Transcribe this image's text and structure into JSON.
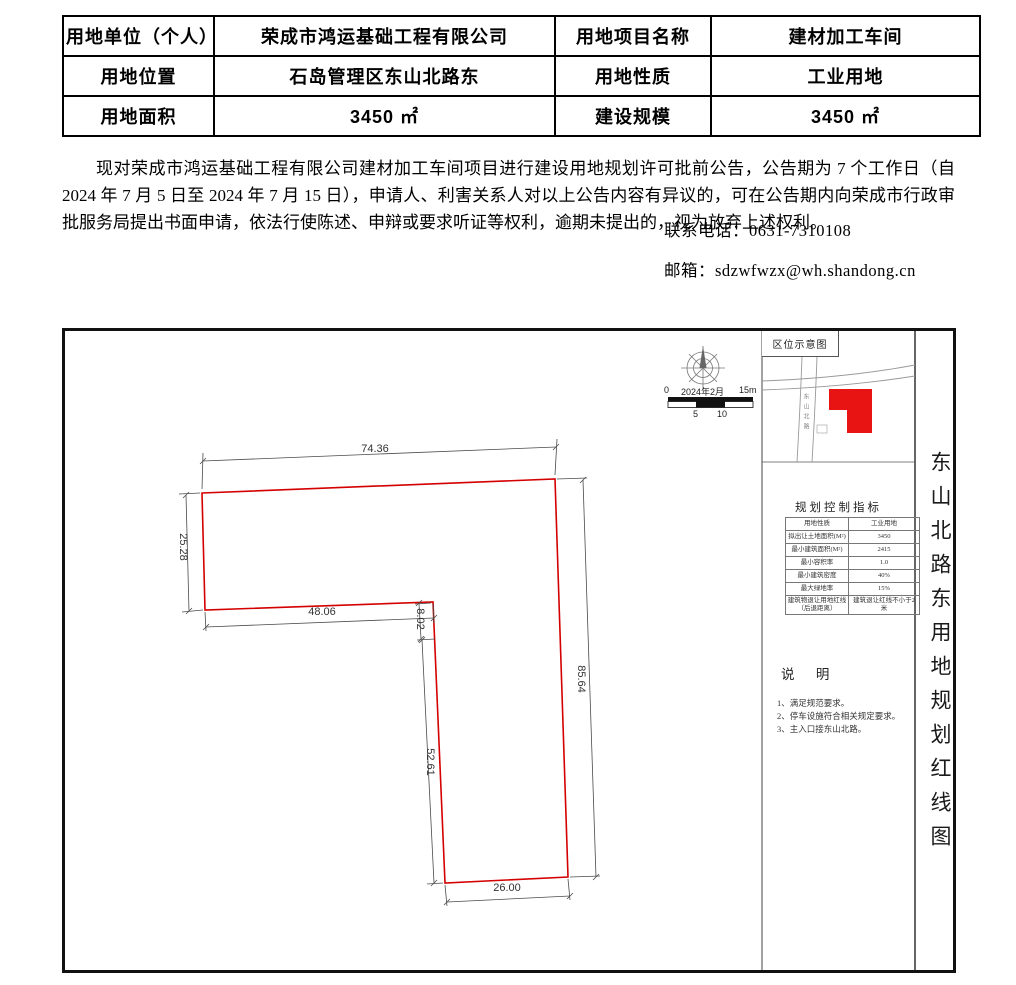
{
  "info_table": {
    "rows": [
      [
        "用地单位（个人）",
        "荣成市鸿运基础工程有限公司",
        "用地项目名称",
        "建材加工车间"
      ],
      [
        "用地位置",
        "石岛管理区东山北路东",
        "用地性质",
        "工业用地"
      ],
      [
        "用地面积",
        "3450 ㎡",
        "建设规模",
        "3450 ㎡"
      ]
    ]
  },
  "announcement": {
    "text": "现对荣成市鸿运基础工程有限公司建材加工车间项目进行建设用地规划许可批前公告，公告期为 7 个工作日（自 2024 年 7 月 5 日至 2024 年 7 月 15 日），申请人、利害关系人对以上公告内容有异议的，可在公告期内向荣成市行政审批服务局提出书面申请，依法行使陈述、申辩或要求听证等权利，逾期未提出的，视为放弃上述权利。"
  },
  "contact": {
    "phone": "联系电话：0631-7310108",
    "email": "邮箱：sdzwfwzx@wh.shandong.cn"
  },
  "figure": {
    "side_title": "东山北路东用地规划红线图",
    "scale_bar": {
      "start": "0",
      "date": "2024年2月",
      "end": "15m",
      "tick5": "5",
      "tick10": "10"
    },
    "dimensions": {
      "top": "74.36",
      "left": "25.28",
      "inner": "48.06",
      "jog": "8.02",
      "leg": "52.61",
      "right": "85.64",
      "bottom": "26.00"
    },
    "inset": {
      "title": "区位示意图",
      "road_name": "东山北路"
    },
    "indicators": {
      "title": "规划控制指标",
      "rows": [
        [
          "用地性质",
          "工业用地"
        ],
        [
          "拟出让土地面积(M²)",
          "3450"
        ],
        [
          "最小建筑面积(M²)",
          "2415"
        ],
        [
          "最小容积率",
          "1.0"
        ],
        [
          "最小建筑密度",
          "40%"
        ],
        [
          "最大绿地率",
          "15%"
        ],
        [
          "建筑物退让用地红线（后退距离）",
          "建筑退让红线不小于2米"
        ]
      ]
    },
    "notes": {
      "title": "说  明",
      "items": [
        "1、满足规范要求。",
        "2、停车设施符合相关规定要求。",
        "3、主入口接东山北路。"
      ]
    },
    "colors": {
      "redline": "#d40000",
      "parcel_fill": "#e81313"
    }
  }
}
